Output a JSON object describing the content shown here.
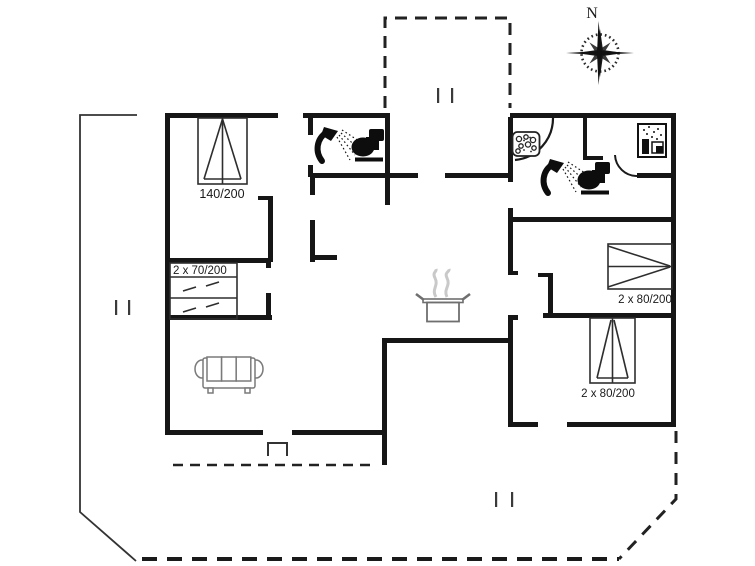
{
  "plan": {
    "compass": {
      "label": "N"
    },
    "labels": {
      "bed_nw": "140/200",
      "bunk_w": "2 x 70/200",
      "bed_e": "2 x 80/200",
      "bed_se": "2 x 80/200"
    },
    "icons": [
      "compass-rose-icon",
      "shower-icon",
      "toilet-icon",
      "washbasin-icon",
      "washing-machine-icon",
      "cooking-pot-icon",
      "sofa-icon",
      "double-bed-icon",
      "bunk-bed-icon",
      "terrace-step-icon"
    ],
    "colors": {
      "wall": "#161616",
      "thin_line": "#2e2e2e",
      "furniture_line": "#7a7a7a",
      "steam": "#c9c9c9",
      "background": "#ffffff"
    }
  }
}
